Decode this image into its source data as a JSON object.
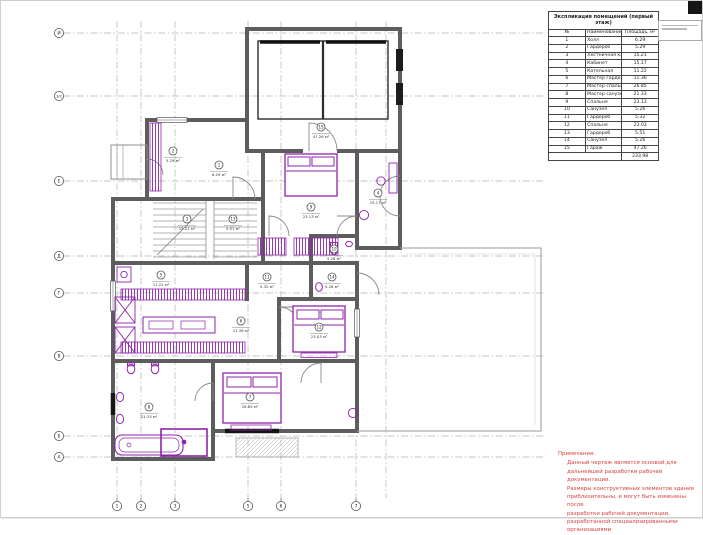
{
  "sheet": {
    "kind": "architectural floor plan",
    "accent_color": "#8e24aa",
    "wall_color": "#5d5d5d",
    "grid_color": "#b3b3b3"
  },
  "table": {
    "title": "Экспликация помещений (первый этаж)",
    "columns": [
      "№",
      "Наименование",
      "Площадь, м²"
    ],
    "rows": [
      [
        "1",
        "Холл",
        "6.29"
      ],
      [
        "2",
        "Гардероб",
        "5.29"
      ],
      [
        "3",
        "Лестничная клетка",
        "15.21"
      ],
      [
        "4",
        "Кабинет",
        "15.17"
      ],
      [
        "5",
        "Котельная",
        "11.22"
      ],
      [
        "6",
        "Мастер гардероб",
        "11.36"
      ],
      [
        "7",
        "Мастер спальня",
        "26.85"
      ],
      [
        "8",
        "Мастер санузел",
        "21.33"
      ],
      [
        "9",
        "Спальня",
        "23.13"
      ],
      [
        "10",
        "Санузел",
        "5.26"
      ],
      [
        "11",
        "Гардероб",
        "5.32"
      ],
      [
        "12",
        "Спальня",
        "23.03"
      ],
      [
        "13",
        "Гардероб",
        "5.51"
      ],
      [
        "14",
        "Санузел",
        "5.26"
      ],
      [
        "15",
        "Гараж",
        "47.26"
      ]
    ],
    "total": "233.98"
  },
  "notes": {
    "title": "Примечания:",
    "color": "#d9413d",
    "lines": [
      "Данный чертеж является основой для",
      "дальнейшей разработки рабочей документации.",
      "Размеры конструктивных элементов здания",
      "приблизительны, и могут быть изменены после",
      "разработки рабочей документации,",
      "разработанной специализированными",
      "организациями"
    ]
  },
  "grid": {
    "left_bubbles": [
      {
        "label": "И",
        "y": 32
      },
      {
        "label": "3/2",
        "y": 95
      },
      {
        "label": "Е",
        "y": 180
      },
      {
        "label": "Д",
        "y": 255
      },
      {
        "label": "Г",
        "y": 292
      },
      {
        "label": "В",
        "y": 355
      },
      {
        "label": "Б",
        "y": 435
      },
      {
        "label": "А",
        "y": 456
      }
    ],
    "bottom_bubbles": [
      {
        "label": "1",
        "x": 116
      },
      {
        "label": "2",
        "x": 140
      },
      {
        "label": "3",
        "x": 174
      },
      {
        "label": "5",
        "x": 247
      },
      {
        "label": "6",
        "x": 280
      },
      {
        "label": "7",
        "x": 355
      },
      {
        "label": "",
        "x": 385
      }
    ]
  },
  "rooms": [
    {
      "num": "1",
      "area": "6.29 м²",
      "x": 218,
      "y": 164
    },
    {
      "num": "2",
      "area": "5.29 м²",
      "x": 172,
      "y": 150
    },
    {
      "num": "3",
      "area": "15.21 м²",
      "x": 186,
      "y": 218
    },
    {
      "num": "13",
      "area": "5.51 м²",
      "x": 232,
      "y": 218
    },
    {
      "num": "4",
      "area": "15.17 м²",
      "x": 377,
      "y": 192
    },
    {
      "num": "9",
      "area": "23.13 м²",
      "x": 310,
      "y": 206
    },
    {
      "num": "10",
      "area": "5.26 м²",
      "x": 333,
      "y": 248
    },
    {
      "num": "5",
      "area": "11.22 м²",
      "x": 160,
      "y": 274
    },
    {
      "num": "11",
      "area": "5.32 м²",
      "x": 266,
      "y": 276
    },
    {
      "num": "14",
      "area": "5.26 м²",
      "x": 331,
      "y": 276
    },
    {
      "num": "6",
      "area": "11.36 м²",
      "x": 240,
      "y": 320
    },
    {
      "num": "12",
      "area": "23.03 м²",
      "x": 318,
      "y": 326
    },
    {
      "num": "8",
      "area": "21.33 м²",
      "x": 148,
      "y": 406
    },
    {
      "num": "7",
      "area": "26.85 м²",
      "x": 249,
      "y": 396
    },
    {
      "num": "15",
      "area": "47.26 м²",
      "x": 320,
      "y": 126
    }
  ]
}
